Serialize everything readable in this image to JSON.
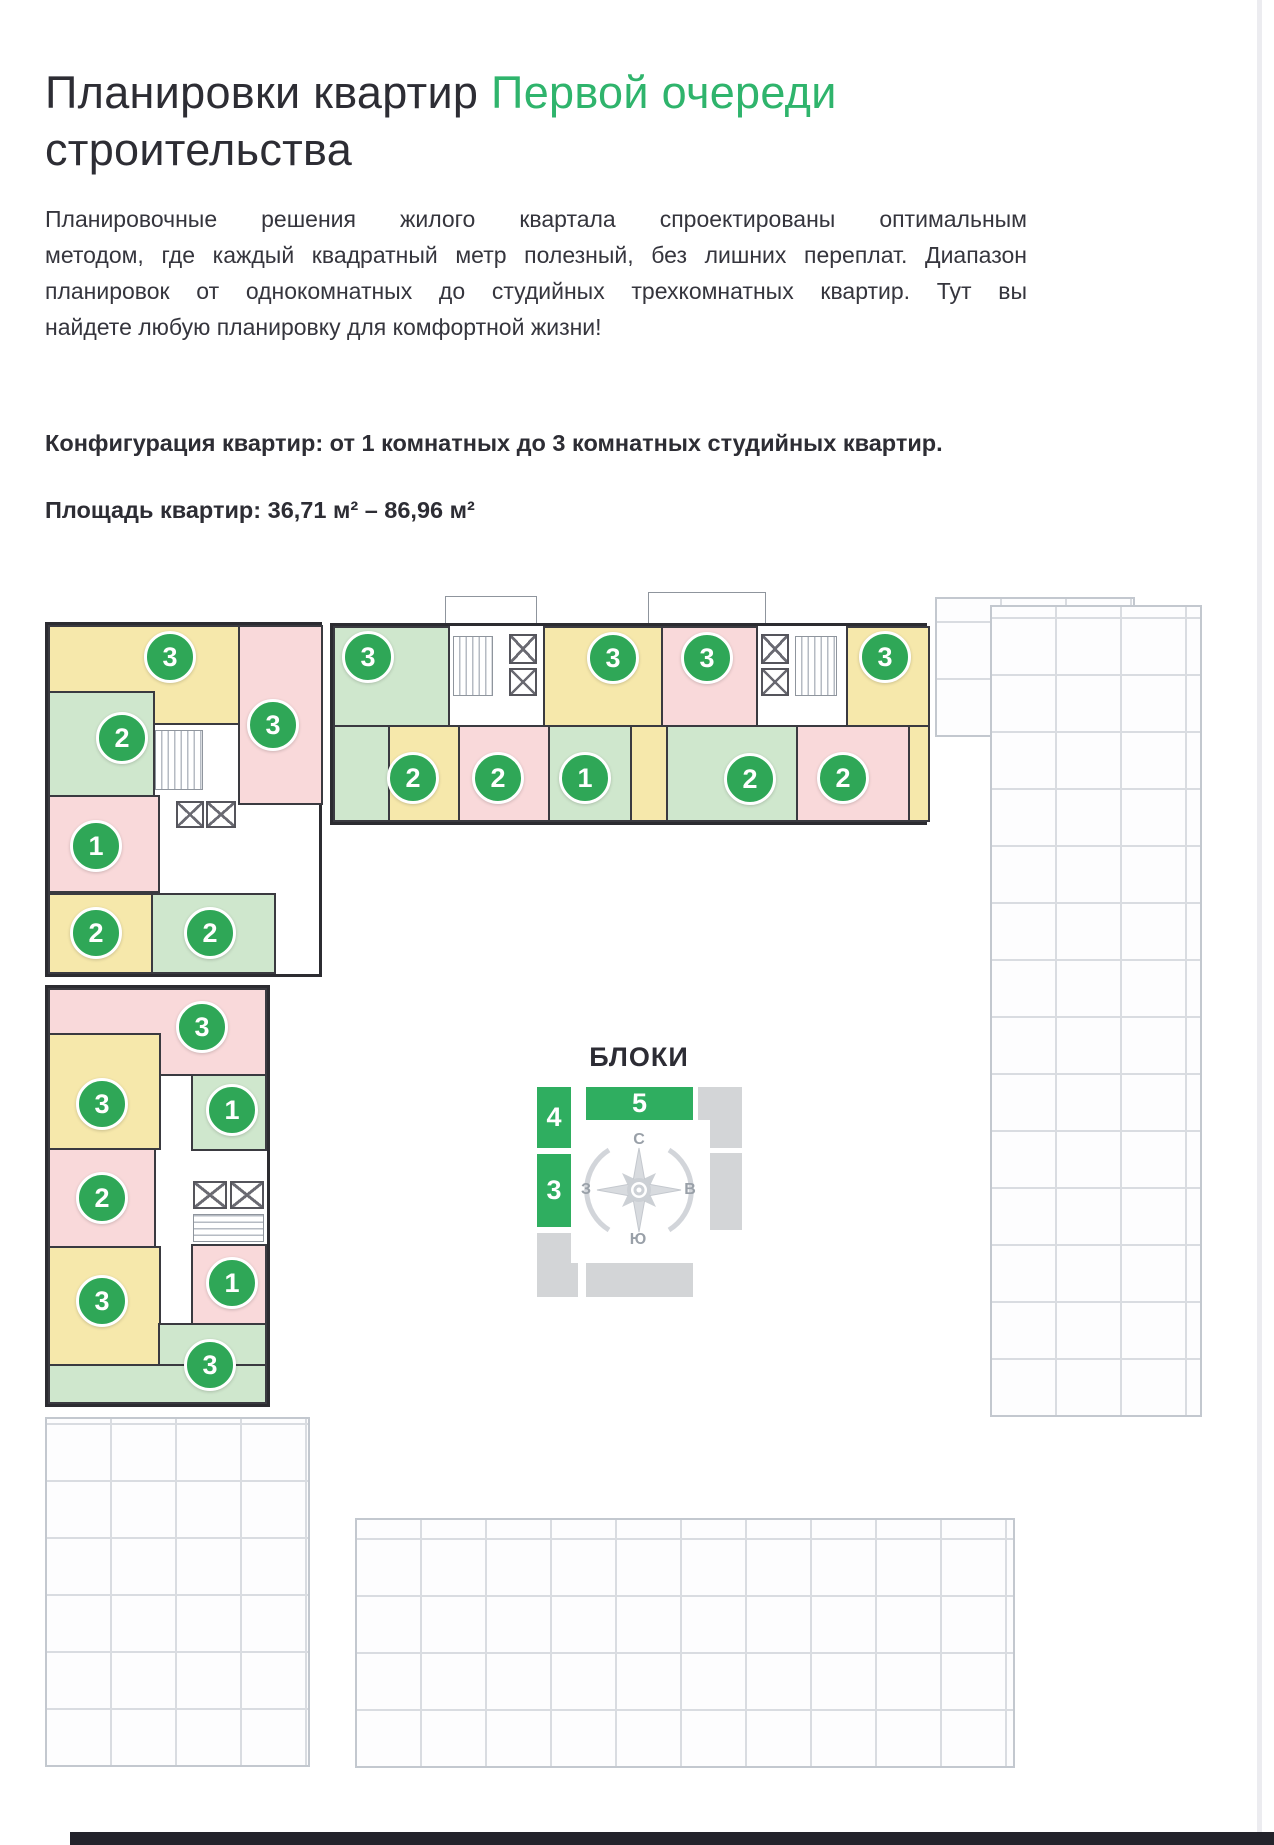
{
  "header": {
    "title_prefix": "Планировки квартир ",
    "title_highlight": "Первой очереди",
    "title_suffix": "строительства"
  },
  "intro": {
    "lines": [
      "Планировочные решения жилого квартала спроектированы оптимальным",
      "методом, где каждый квадратный метр полезный, без лишних переплат. Диапазон",
      "планировок от однокомнатных до студийных трехкомнатных квартир. Тут вы",
      "найдете любую планировку для комфортной жизни!"
    ],
    "configuration": "Конфигурация квартир: от 1 комнатных до 3 комнатных студийных квартир.",
    "area": "Площадь квартир: 36,71 м² – 86,96 м²"
  },
  "legend": {
    "title": "БЛОКИ",
    "green_blocks": [
      {
        "label": "4"
      },
      {
        "label": "5"
      },
      {
        "label": "3"
      }
    ],
    "compass": {
      "north": "С",
      "east": "В",
      "south": "Ю",
      "west": "З"
    }
  },
  "plan": {
    "palette": {
      "badge_green": "#2fa757",
      "title_green": "#2fb46c",
      "legend_green": "#2fae60",
      "room_yellow": "#f6e8ab",
      "room_pink": "#f9d9da",
      "room_green": "#cfe7cd",
      "wall_dark": "#2c2c31",
      "faded_gray": "#c9cdd3",
      "legend_gray": "#d3d5d7"
    },
    "badges": [
      {
        "block": 4,
        "rooms": "3",
        "color": "yellow",
        "x": 170,
        "y": 657
      },
      {
        "block": 4,
        "rooms": "3",
        "color": "pink",
        "x": 273,
        "y": 725
      },
      {
        "block": 4,
        "rooms": "2",
        "color": "green",
        "x": 122,
        "y": 738
      },
      {
        "block": 4,
        "rooms": "1",
        "color": "pink",
        "x": 96,
        "y": 846
      },
      {
        "block": 4,
        "rooms": "2",
        "color": "yellow",
        "x": 96,
        "y": 933
      },
      {
        "block": 4,
        "rooms": "2",
        "color": "green",
        "x": 210,
        "y": 933
      },
      {
        "block": 5,
        "rooms": "3",
        "color": "green",
        "x": 368,
        "y": 657
      },
      {
        "block": 5,
        "rooms": "3",
        "color": "yellow",
        "x": 613,
        "y": 658
      },
      {
        "block": 5,
        "rooms": "3",
        "color": "pink",
        "x": 707,
        "y": 658
      },
      {
        "block": 5,
        "rooms": "3",
        "color": "yellow",
        "x": 885,
        "y": 657
      },
      {
        "block": 5,
        "rooms": "2",
        "color": "yellow",
        "x": 413,
        "y": 778
      },
      {
        "block": 5,
        "rooms": "2",
        "color": "pink",
        "x": 498,
        "y": 778
      },
      {
        "block": 5,
        "rooms": "1",
        "color": "green",
        "x": 585,
        "y": 778
      },
      {
        "block": 5,
        "rooms": "2",
        "color": "green",
        "x": 750,
        "y": 779
      },
      {
        "block": 5,
        "rooms": "2",
        "color": "pink",
        "x": 843,
        "y": 778
      },
      {
        "block": 3,
        "rooms": "3",
        "color": "pink",
        "x": 202,
        "y": 1027
      },
      {
        "block": 3,
        "rooms": "3",
        "color": "yellow",
        "x": 102,
        "y": 1104
      },
      {
        "block": 3,
        "rooms": "1",
        "color": "green",
        "x": 232,
        "y": 1110
      },
      {
        "block": 3,
        "rooms": "2",
        "color": "pink",
        "x": 102,
        "y": 1198
      },
      {
        "block": 3,
        "rooms": "1",
        "color": "pink",
        "x": 232,
        "y": 1283
      },
      {
        "block": 3,
        "rooms": "3",
        "color": "yellow",
        "x": 102,
        "y": 1301
      },
      {
        "block": 3,
        "rooms": "3",
        "color": "green",
        "x": 210,
        "y": 1365
      }
    ]
  }
}
